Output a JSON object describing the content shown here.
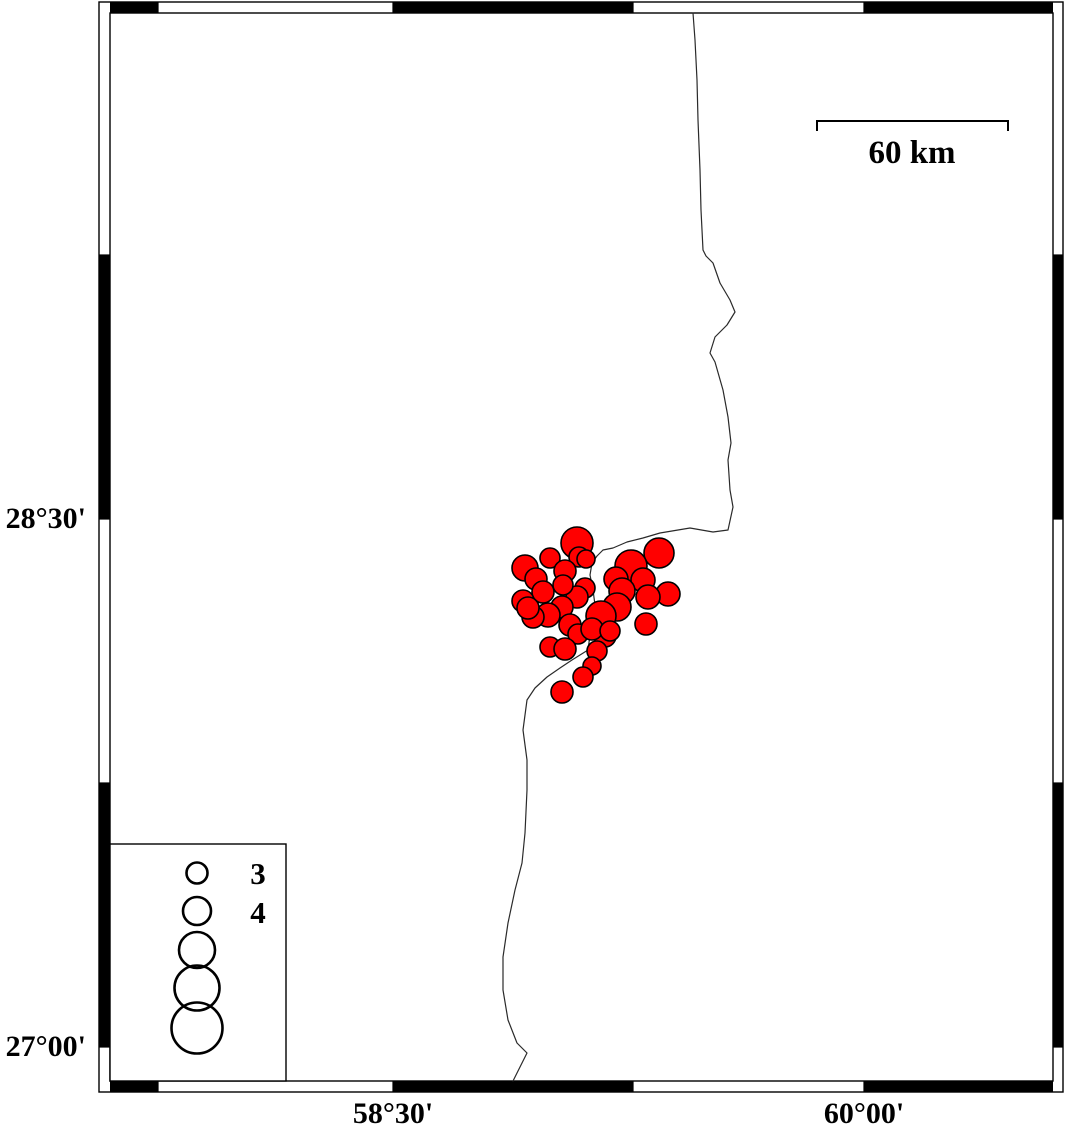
{
  "figure": {
    "type": "seismicity-map",
    "description": "Epicenter map with magnitude-scaled red circles, coastline, fancy checkered frame, scale bar and magnitude legend"
  },
  "map": {
    "colors": {
      "quake_fill": "#ff0000",
      "quake_stroke": "#000000",
      "coast": "#2a2a2a",
      "frame": "#000000",
      "background": "#ffffff"
    },
    "frame": {
      "outer": [
        99,
        2,
        1063,
        1092
      ],
      "inner": [
        110,
        13,
        1053,
        1081
      ],
      "top_black_segments": [
        [
          110,
          158
        ],
        [
          393,
          633
        ],
        [
          864,
          1053
        ]
      ],
      "side_black_segments": [
        [
          255,
          519
        ],
        [
          783,
          1047
        ]
      ],
      "x_transitions": [
        158,
        393,
        633,
        864
      ],
      "y_transitions": [
        255,
        519,
        783,
        1047
      ]
    },
    "x_axis": {
      "labels": [
        {
          "text": "58°30'",
          "x": 393
        },
        {
          "text": "60°00'",
          "x": 864
        }
      ]
    },
    "y_axis": {
      "labels": [
        {
          "text": "28°30'",
          "y": 519
        },
        {
          "text": "27°00'",
          "y": 1047
        }
      ]
    },
    "scale_bar": {
      "x1": 817,
      "x2": 1008,
      "y": 121,
      "tick_drop": 10,
      "label": "60 km"
    },
    "legend": {
      "box": [
        110,
        844,
        286,
        1081
      ],
      "circle_x": 197,
      "circles": [
        {
          "y": 873,
          "r": 10.5,
          "label": "3"
        },
        {
          "y": 911,
          "r": 14,
          "label": "4"
        },
        {
          "y": 950,
          "r": 18,
          "label": ""
        },
        {
          "y": 988,
          "r": 22.5,
          "label": ""
        },
        {
          "y": 1028,
          "r": 25.5,
          "label": ""
        }
      ]
    },
    "coastline": [
      [
        693,
        13
      ],
      [
        695,
        40
      ],
      [
        697,
        80
      ],
      [
        698,
        120
      ],
      [
        700,
        170
      ],
      [
        701,
        210
      ],
      [
        703,
        250
      ],
      [
        706,
        256
      ],
      [
        713,
        263
      ],
      [
        720,
        283
      ],
      [
        730,
        300
      ],
      [
        735,
        312
      ],
      [
        727,
        325
      ],
      [
        715,
        337
      ],
      [
        710,
        353
      ],
      [
        715,
        362
      ],
      [
        723,
        390
      ],
      [
        728,
        417
      ],
      [
        731,
        443
      ],
      [
        728,
        460
      ],
      [
        730,
        490
      ],
      [
        733,
        507
      ],
      [
        728,
        530
      ],
      [
        713,
        532
      ],
      [
        690,
        528
      ],
      [
        660,
        533
      ],
      [
        643,
        538
      ],
      [
        627,
        542
      ],
      [
        613,
        548
      ],
      [
        603,
        550
      ],
      [
        597,
        556
      ],
      [
        592,
        563
      ],
      [
        590,
        575
      ],
      [
        593,
        590
      ],
      [
        595,
        605
      ],
      [
        593,
        620
      ],
      [
        590,
        635
      ],
      [
        588,
        650
      ],
      [
        572,
        660
      ],
      [
        560,
        668
      ],
      [
        547,
        677
      ],
      [
        535,
        688
      ],
      [
        527,
        700
      ],
      [
        523,
        730
      ],
      [
        527,
        760
      ],
      [
        527,
        790
      ],
      [
        525,
        833
      ],
      [
        522,
        863
      ],
      [
        515,
        890
      ],
      [
        508,
        923
      ],
      [
        503,
        957
      ],
      [
        503,
        990
      ],
      [
        508,
        1020
      ],
      [
        517,
        1043
      ],
      [
        527,
        1053
      ],
      [
        522,
        1063
      ],
      [
        515,
        1077
      ],
      [
        513,
        1081
      ]
    ],
    "earthquakes": [
      [
        577,
        543,
        16
      ],
      [
        579,
        557,
        10
      ],
      [
        586,
        559,
        9
      ],
      [
        550,
        558,
        10
      ],
      [
        525,
        568,
        13
      ],
      [
        536,
        579,
        11
      ],
      [
        565,
        571,
        11
      ],
      [
        659,
        553,
        15
      ],
      [
        631,
        566,
        16
      ],
      [
        616,
        579,
        12
      ],
      [
        643,
        580,
        12
      ],
      [
        668,
        594,
        12
      ],
      [
        648,
        597,
        12
      ],
      [
        622,
        591,
        13
      ],
      [
        617,
        607,
        14
      ],
      [
        646,
        624,
        11
      ],
      [
        601,
        616,
        15
      ],
      [
        605,
        636,
        11
      ],
      [
        585,
        588,
        10
      ],
      [
        577,
        597,
        11
      ],
      [
        563,
        585,
        10
      ],
      [
        543,
        592,
        11
      ],
      [
        562,
        607,
        11
      ],
      [
        548,
        615,
        12
      ],
      [
        533,
        617,
        11
      ],
      [
        523,
        601,
        11
      ],
      [
        528,
        608,
        11
      ],
      [
        570,
        625,
        11
      ],
      [
        578,
        634,
        10
      ],
      [
        592,
        629,
        11
      ],
      [
        550,
        647,
        10
      ],
      [
        565,
        649,
        11
      ],
      [
        597,
        651,
        10
      ],
      [
        610,
        631,
        10
      ],
      [
        592,
        666,
        9
      ],
      [
        583,
        677,
        10
      ],
      [
        562,
        692,
        11
      ]
    ]
  }
}
